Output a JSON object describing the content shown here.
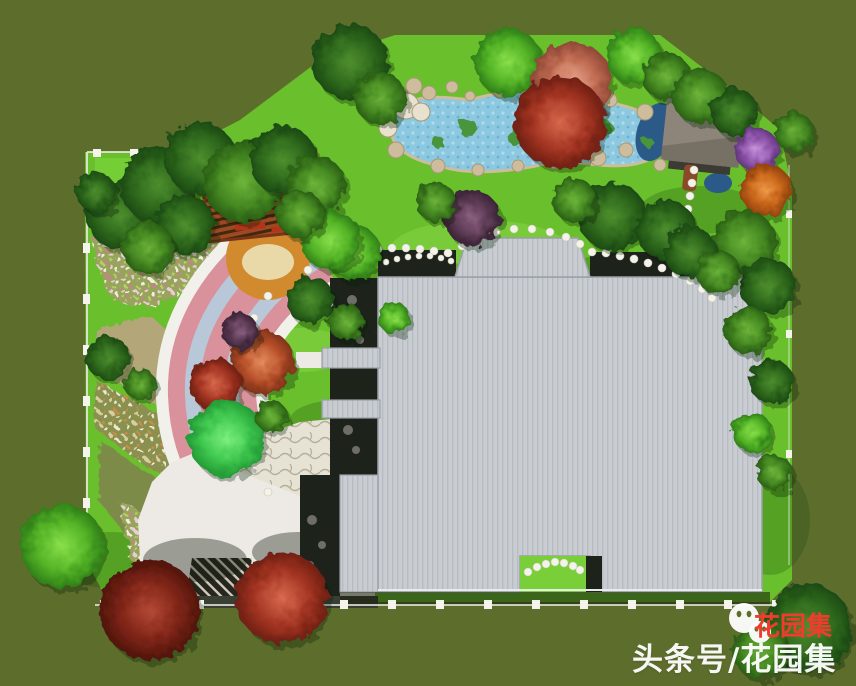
{
  "watermark": {
    "white_text": "头条号/花园集",
    "red_text": "花园集",
    "logo_icon": "wechat-two-faces"
  },
  "colors": {
    "bg_olive": "#5d6d2c",
    "lawn": "#6abf2d",
    "lawn_bright": "#78cf37",
    "pond": "#8cc8e0",
    "pond_deep": "#2c5a88",
    "pond_plant": "#49953b",
    "rock_tan": "#cdbd9c",
    "rock_light": "#e8e1ce",
    "roof": "#c9cdd2",
    "roof_stripe": "#b4bac1",
    "roof_edge": "#9aa0a8",
    "pav_roof": "#8d8579",
    "pav_roof_dark": "#6e675c",
    "court_dark": "#1d231b",
    "flag_light": "#e6e2d4",
    "plaza_white": "#edeae5",
    "arc_pink": "#d9929b",
    "arc_blue": "#b9c8d8",
    "arc_white": "#f2f0ea",
    "deck_wood": "#d28a2e",
    "sand": "#ead9a8",
    "pergola_red": "#9c4a21",
    "pergola_dark": "#43270f",
    "wall_brown": "#4a3b33",
    "fence": "#f4f4ec",
    "mosaic_dark": "#26261f",
    "mosaic_stripe": "#cfcabc",
    "bed_tan": "#b3a779",
    "bed_olive": "#7d8b4a",
    "bed_green": "#8fae5a",
    "wm_red": "#f03c2e",
    "wm_white": "#ffffff"
  },
  "scene": {
    "trees": [
      [
        120,
        215,
        34,
        "d"
      ],
      [
        158,
        185,
        38,
        "d"
      ],
      [
        200,
        158,
        36,
        "d"
      ],
      [
        243,
        182,
        40,
        "m"
      ],
      [
        185,
        225,
        30,
        "d"
      ],
      [
        283,
        160,
        34,
        "d"
      ],
      [
        316,
        186,
        30,
        "m"
      ],
      [
        148,
        248,
        26,
        "m"
      ],
      [
        96,
        192,
        20,
        "d"
      ],
      [
        350,
        62,
        38,
        "d"
      ],
      [
        380,
        98,
        26,
        "m"
      ],
      [
        508,
        62,
        34,
        "b"
      ],
      [
        572,
        82,
        40,
        "sa"
      ],
      [
        634,
        56,
        28,
        "b"
      ],
      [
        666,
        76,
        24,
        "m"
      ],
      [
        560,
        122,
        46,
        "r"
      ],
      [
        700,
        96,
        28,
        "m"
      ],
      [
        734,
        112,
        24,
        "d"
      ],
      [
        757,
        150,
        22,
        "p"
      ],
      [
        766,
        190,
        26,
        "o"
      ],
      [
        794,
        132,
        20,
        "m"
      ],
      [
        744,
        242,
        32,
        "m"
      ],
      [
        768,
        286,
        28,
        "d"
      ],
      [
        748,
        330,
        24,
        "m"
      ],
      [
        772,
        382,
        22,
        "d"
      ],
      [
        752,
        432,
        20,
        "b"
      ],
      [
        774,
        472,
        18,
        "m"
      ],
      [
        612,
        216,
        34,
        "d"
      ],
      [
        666,
        230,
        30,
        "d"
      ],
      [
        574,
        200,
        22,
        "m"
      ],
      [
        690,
        252,
        26,
        "d"
      ],
      [
        718,
        272,
        22,
        "m"
      ],
      [
        472,
        218,
        28,
        "pd"
      ],
      [
        436,
        202,
        20,
        "m"
      ],
      [
        352,
        252,
        28,
        "b"
      ],
      [
        310,
        300,
        24,
        "d"
      ],
      [
        346,
        322,
        18,
        "m"
      ],
      [
        394,
        318,
        16,
        "b"
      ],
      [
        330,
        240,
        30,
        "b"
      ],
      [
        300,
        214,
        24,
        "m"
      ],
      [
        262,
        362,
        32,
        "ru"
      ],
      [
        240,
        331,
        18,
        "pd"
      ],
      [
        215,
        384,
        26,
        "r"
      ],
      [
        226,
        438,
        38,
        "s"
      ],
      [
        271,
        416,
        16,
        "m"
      ],
      [
        108,
        358,
        22,
        "d"
      ],
      [
        140,
        384,
        16,
        "m"
      ],
      [
        62,
        546,
        42,
        "b"
      ],
      [
        150,
        610,
        50,
        "dr"
      ],
      [
        282,
        598,
        46,
        "r"
      ],
      [
        808,
        628,
        44,
        "d"
      ],
      [
        760,
        650,
        28,
        "m"
      ]
    ],
    "rocks": [
      [
        398,
        96,
        10
      ],
      [
        414,
        86,
        8
      ],
      [
        429,
        93,
        7
      ],
      [
        452,
        87,
        6
      ],
      [
        388,
        128,
        9,
        "w"
      ],
      [
        396,
        150,
        8
      ],
      [
        438,
        166,
        7
      ],
      [
        478,
        170,
        6
      ],
      [
        518,
        166,
        6
      ],
      [
        554,
        162,
        7
      ],
      [
        598,
        158,
        8
      ],
      [
        626,
        150,
        7
      ],
      [
        645,
        112,
        8
      ],
      [
        610,
        100,
        7
      ],
      [
        578,
        92,
        6
      ],
      [
        544,
        88,
        7
      ],
      [
        500,
        92,
        6
      ],
      [
        470,
        96,
        5
      ],
      [
        660,
        165,
        6
      ],
      [
        406,
        106,
        13,
        "w"
      ],
      [
        421,
        112,
        9,
        "w"
      ]
    ],
    "pond_plants": [
      [
        468,
        128,
        9
      ],
      [
        515,
        138,
        7
      ],
      [
        558,
        132,
        6
      ],
      [
        606,
        128,
        7
      ],
      [
        648,
        142,
        5
      ],
      [
        438,
        142,
        6
      ]
    ],
    "stepping_paths": [
      {
        "r": 4,
        "dots": [
          [
            308,
            270
          ],
          [
            322,
            263
          ],
          [
            336,
            258
          ],
          [
            350,
            254
          ],
          [
            364,
            251
          ],
          [
            378,
            249
          ],
          [
            392,
            248
          ],
          [
            406,
            248
          ],
          [
            420,
            249
          ],
          [
            434,
            251
          ],
          [
            448,
            253
          ]
        ]
      },
      {
        "r": 4,
        "dots": [
          [
            462,
            246
          ],
          [
            478,
            238
          ],
          [
            496,
            232
          ],
          [
            514,
            229
          ],
          [
            532,
            229
          ],
          [
            550,
            232
          ],
          [
            566,
            237
          ],
          [
            580,
            244
          ]
        ]
      },
      {
        "r": 4,
        "dots": [
          [
            592,
            252
          ],
          [
            606,
            253
          ],
          [
            620,
            256
          ],
          [
            634,
            259
          ],
          [
            648,
            263
          ],
          [
            662,
            268
          ],
          [
            676,
            274
          ],
          [
            690,
            281
          ],
          [
            702,
            289
          ],
          [
            712,
            298
          ]
        ]
      },
      {
        "r": 4,
        "dots": [
          [
            694,
            170
          ],
          [
            692,
            183
          ],
          [
            690,
            196
          ],
          [
            688,
            209
          ],
          [
            686,
            222
          ],
          [
            685,
            235
          ],
          [
            684,
            248
          ]
        ]
      },
      {
        "r": 4,
        "dots": [
          [
            528,
            572
          ],
          [
            537,
            567
          ],
          [
            546,
            564
          ],
          [
            555,
            562
          ],
          [
            564,
            563
          ],
          [
            573,
            566
          ],
          [
            580,
            570
          ]
        ]
      },
      {
        "r": 4,
        "dots": [
          [
            268,
            296
          ],
          [
            254,
            318
          ],
          [
            243,
            342
          ],
          [
            236,
            368
          ],
          [
            233,
            394
          ],
          [
            236,
            420
          ],
          [
            243,
            446
          ],
          [
            254,
            470
          ],
          [
            268,
            492
          ]
        ]
      },
      {
        "r": 3,
        "dots": [
          [
            305,
            287
          ],
          [
            318,
            295
          ],
          [
            330,
            304
          ],
          [
            341,
            314
          ],
          [
            350,
            325
          ]
        ]
      },
      {
        "r": 3,
        "dots": [
          [
            386,
            262
          ],
          [
            397,
            259
          ],
          [
            408,
            257
          ],
          [
            419,
            256
          ],
          [
            430,
            256
          ],
          [
            441,
            258
          ],
          [
            451,
            261
          ]
        ]
      }
    ],
    "fence_posts": {
      "left": [
        [
          83,
          192,
          7,
          10
        ],
        [
          83,
          243,
          7,
          10
        ],
        [
          83,
          294,
          7,
          10
        ],
        [
          83,
          345,
          7,
          10
        ],
        [
          83,
          396,
          7,
          10
        ],
        [
          83,
          447,
          7,
          10
        ],
        [
          83,
          498,
          7,
          10
        ],
        [
          83,
          549,
          7,
          10
        ]
      ],
      "top": [
        [
          93,
          149,
          8,
          8
        ],
        [
          130,
          149,
          8,
          8
        ],
        [
          167,
          149,
          8,
          8
        ]
      ],
      "bottom": [
        [
          100,
          600,
          8,
          9
        ],
        [
          148,
          600,
          8,
          9
        ],
        [
          196,
          600,
          8,
          9
        ],
        [
          244,
          600,
          8,
          9
        ],
        [
          292,
          600,
          8,
          9
        ],
        [
          340,
          600,
          8,
          9
        ],
        [
          388,
          600,
          8,
          9
        ],
        [
          436,
          600,
          8,
          9
        ],
        [
          484,
          600,
          8,
          9
        ],
        [
          532,
          600,
          8,
          9
        ],
        [
          580,
          600,
          8,
          9
        ],
        [
          628,
          600,
          8,
          9
        ],
        [
          676,
          600,
          8,
          9
        ],
        [
          724,
          600,
          8,
          9
        ],
        [
          772,
          600,
          8,
          9
        ]
      ],
      "right": [
        [
          786,
          210,
          6,
          8
        ],
        [
          786,
          330,
          6,
          8
        ],
        [
          786,
          450,
          6,
          8
        ]
      ]
    },
    "rails": [
      [
        87,
        152,
        87,
        560,
        0.85
      ],
      [
        87,
        152,
        175,
        152,
        0.85
      ],
      [
        95,
        605,
        780,
        605,
        0.8
      ],
      [
        789,
        165,
        789,
        565,
        0.4
      ]
    ],
    "lawn_shadows": [
      [
        430,
        300,
        95,
        38
      ],
      [
        630,
        285,
        85,
        32
      ],
      [
        255,
        480,
        65,
        26
      ],
      [
        700,
        210,
        60,
        24
      ],
      [
        340,
        420,
        50,
        20
      ],
      [
        770,
        520,
        40,
        55
      ],
      [
        110,
        560,
        60,
        28
      ]
    ],
    "lawn_lights": [
      [
        480,
        250,
        90,
        30
      ],
      [
        300,
        350,
        50,
        22
      ],
      [
        660,
        320,
        40,
        18
      ],
      [
        560,
        575,
        40,
        14
      ]
    ],
    "courtyard_stones": [
      [
        352,
        300,
        5
      ],
      [
        342,
        320,
        4
      ],
      [
        360,
        340,
        4
      ],
      [
        348,
        430,
        5
      ],
      [
        356,
        450,
        4
      ],
      [
        312,
        520,
        5
      ],
      [
        322,
        545,
        4
      ],
      [
        310,
        565,
        4
      ]
    ]
  }
}
